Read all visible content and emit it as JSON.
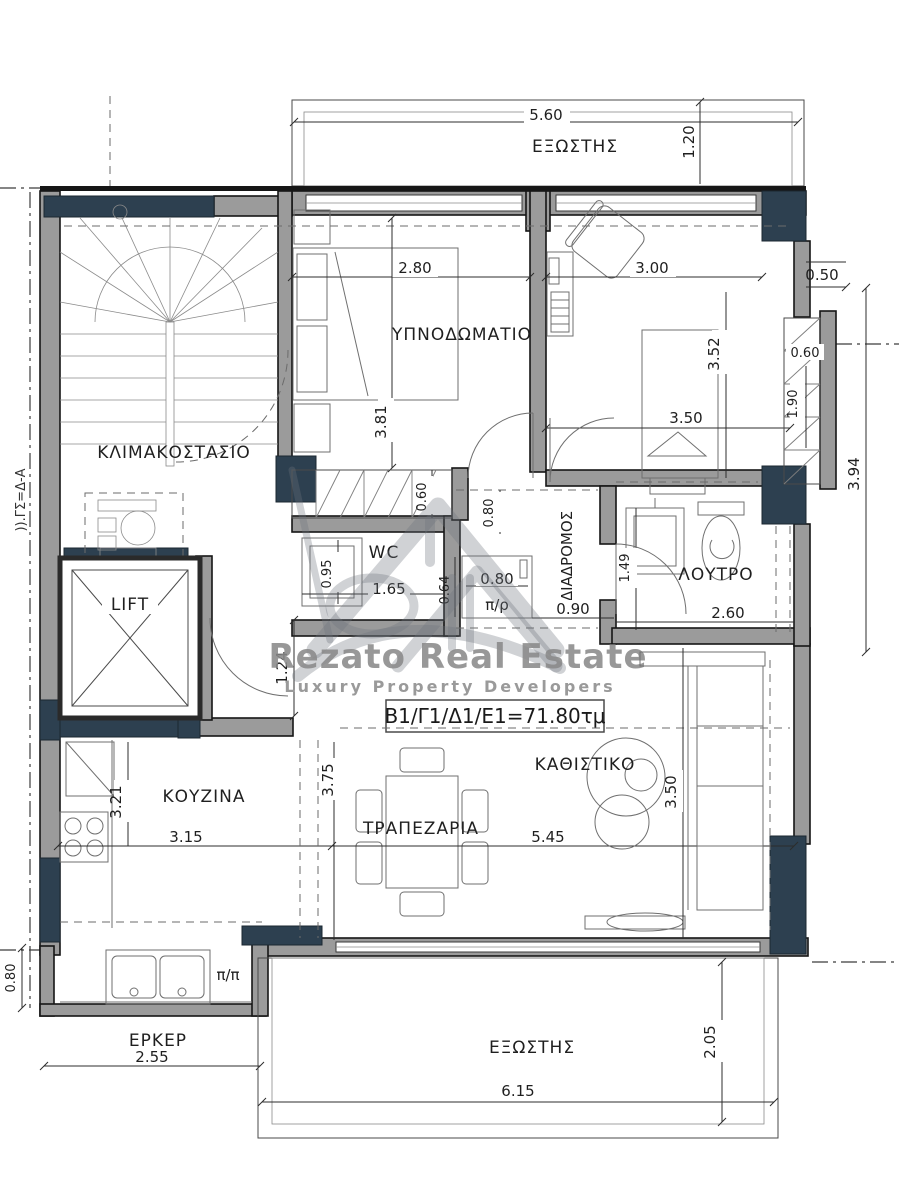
{
  "plan": {
    "watermark": {
      "brand": "Rezato Real Estate",
      "tagline": "Luxury Property Developers",
      "area_label": "Β1/Γ1/Δ1/Ε1=71.80τμ"
    },
    "rooms": {
      "balcony_top": "ΕΞΩΣΤΗΣ",
      "bedroom": "ΥΠΝΟΔΩΜΑΤΙΟ",
      "staircase": "ΚΛΙΜΑΚΟΣΤΑΣΙΟ",
      "lift": "LIFT",
      "wc": "WC",
      "corridor": "ΔΙΑΔΡΟΜΟΣ",
      "bathroom": "ΛΟΥΤΡΟ",
      "kitchen": "ΚΟΥΖΙΝΑ",
      "dining": "ΤΡΑΠΕΖΑΡΙΑ",
      "living": "ΚΑΘΙΣΤΙΚΟ",
      "bay_window": "ΕΡΚΕΡ",
      "balcony_bottom": "ΕΞΩΣΤΗΣ"
    },
    "annotations": {
      "pass_pr": "π/ρ",
      "pass_pp": "π/π",
      "section_mark": ")).ΓΣ=Δ-Α"
    },
    "dims": {
      "top_width": "5.60",
      "balcony_top_depth": "1.20",
      "bedroom_width": "2.80",
      "bedroom2_width": "3.00",
      "right_offset": "0.50",
      "bedroom2_height": "3.52",
      "closet_width": "0.60",
      "closet_height": "1.90",
      "bedroom2_inner_width": "3.50",
      "right_side_height": "3.94",
      "bedroom_height": "3.81",
      "stair_flight_width": "0.60",
      "wc_height": "0.95",
      "wc_width": "1.65",
      "corridor_top": "0.80",
      "cabinet_width": "0.80",
      "cabinet_depth": "0.64",
      "corridor_width": "0.90",
      "bathroom_height": "1.49",
      "bathroom_width": "2.60",
      "entry_hall_height": "1.24",
      "kitchen_height": "3.21",
      "kitchen_width": "3.15",
      "dining_height": "3.75",
      "living_width": "5.45",
      "living_height": "3.50",
      "bay_width": "2.55",
      "bay_depth": "0.80",
      "balcony_bottom_width": "6.15",
      "balcony_bottom_depth": "2.05"
    },
    "colors": {
      "wall_gray": "#9b9b9b",
      "pier_navy": "#2d4050",
      "line_black": "#161616",
      "watermark_gray": "#8a8a8a"
    }
  }
}
